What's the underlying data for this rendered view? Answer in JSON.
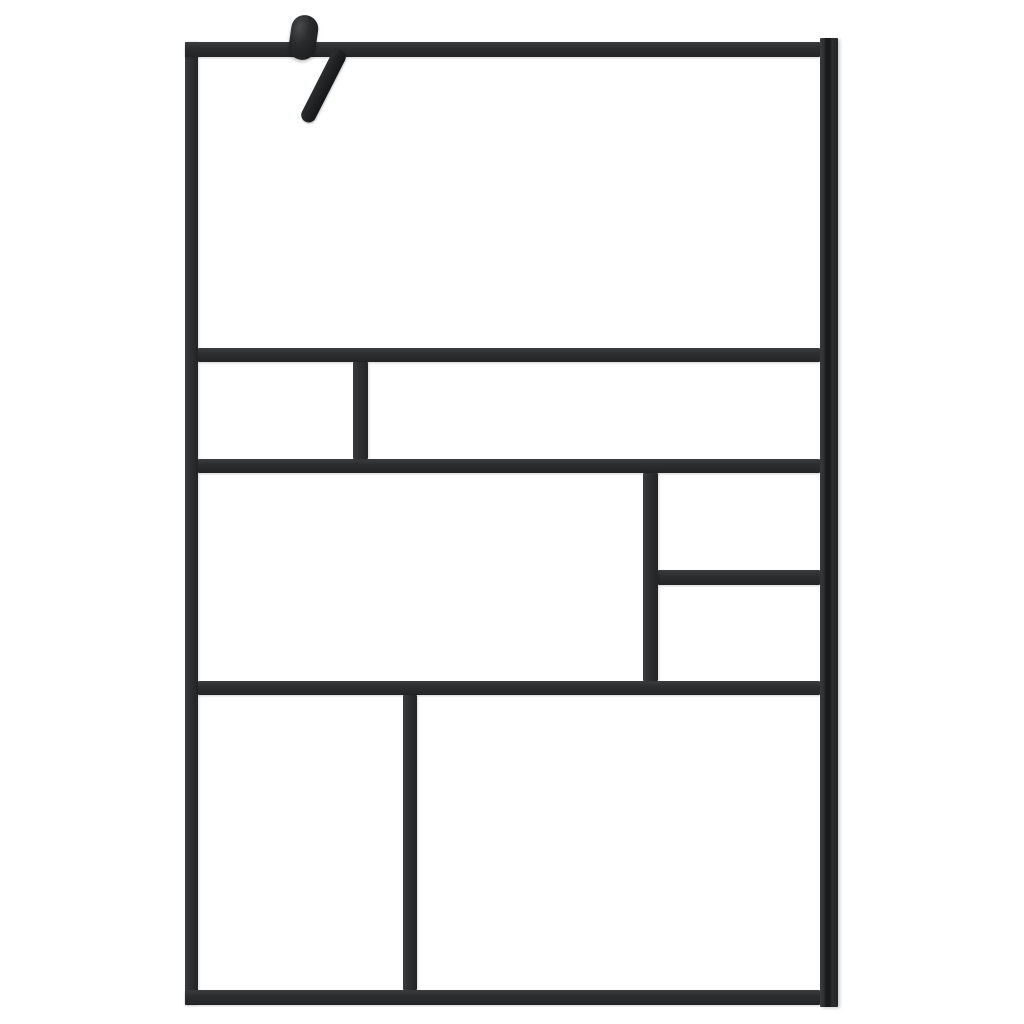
{
  "image": {
    "kind": "product-photo",
    "description": "Walk-in shower screen with black grid frame and clear glass",
    "visible_text": ""
  },
  "colors": {
    "frame": "#2e2f30",
    "frame_light": "#3b3c3e",
    "frame_dark": "#232425",
    "groove": "#1a1b1c",
    "glass": "#ffffff",
    "hardware": "#212223",
    "hardware_highlight": "#4a4b4d",
    "background": "#ffffff"
  },
  "parts": {
    "frame": "black aluminium frame",
    "wall_profile": "wall mounting profile with groove",
    "support_arm": "support arm brace",
    "support_clamp": "support arm clamp knob",
    "glass_pane_top": "large top glass pane",
    "glass_pane_row2_left": "row 2 small left pane",
    "glass_pane_row2_right": "row 2 wide right pane",
    "glass_pane_row3_left": "row 3 large left pane",
    "glass_pane_row3_right_top": "row 3 right upper pane",
    "glass_pane_row3_right_bottom": "row 3 right lower pane",
    "glass_pane_row4_left": "row 4 left pane",
    "glass_pane_row4_right": "row 4 right pane"
  }
}
